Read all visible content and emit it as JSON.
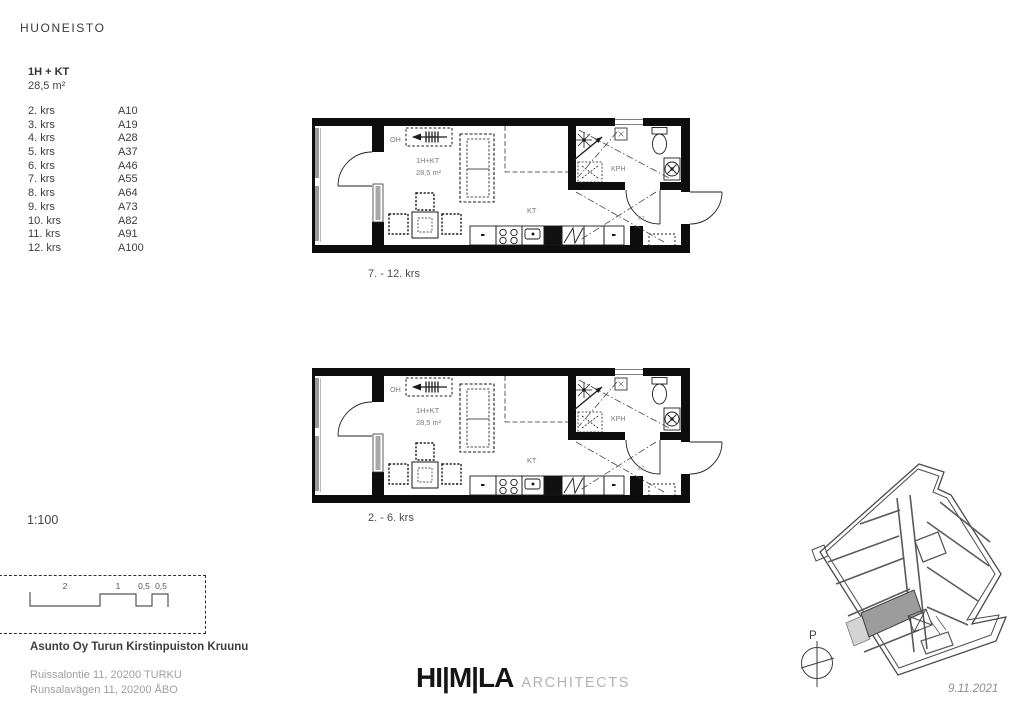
{
  "header": {
    "title": "HUONEISTO"
  },
  "apartment": {
    "type": "1H + KT",
    "area": "28,5 m²"
  },
  "floor_list": [
    {
      "floor": "2. krs",
      "unit": "A10"
    },
    {
      "floor": "3. krs",
      "unit": "A19"
    },
    {
      "floor": "4. krs",
      "unit": "A28"
    },
    {
      "floor": "5. krs",
      "unit": "A37"
    },
    {
      "floor": "6. krs",
      "unit": "A46"
    },
    {
      "floor": "7. krs",
      "unit": "A55"
    },
    {
      "floor": "8. krs",
      "unit": "A64"
    },
    {
      "floor": "9. krs",
      "unit": "A73"
    },
    {
      "floor": "10. krs",
      "unit": "A82"
    },
    {
      "floor": "11. krs",
      "unit": "A91"
    },
    {
      "floor": "12. krs",
      "unit": "A100"
    }
  ],
  "plans": [
    {
      "caption": "7. - 12. krs"
    },
    {
      "caption": "2. - 6. krs"
    }
  ],
  "plan_labels": {
    "living": "OH",
    "type": "1H+KT",
    "area": "28,5 m²",
    "kitchen": "KT",
    "bathroom": "KPH",
    "entry": "ET"
  },
  "scale": {
    "label": "1:100",
    "bar_labels": [
      "2",
      "1",
      "0,5",
      "0,5"
    ]
  },
  "project": {
    "name": "Asunto Oy Turun Kirstinpuiston Kruunu",
    "address_fi": "Ruissalontie 11, 20200 TURKU",
    "address_sv": "Runsalavägen 11, 20200 ÅBO"
  },
  "logo": {
    "name": "HI|M|LA",
    "suffix": "ARCHITECTS"
  },
  "siteplan": {
    "north_label": "P",
    "date": "9.11.2021"
  },
  "colors": {
    "wall": "#0d0d0d",
    "plan_text": "#787878",
    "highlight_unit": "#9c9c9c",
    "highlight_balcony": "#d4d4d4"
  }
}
